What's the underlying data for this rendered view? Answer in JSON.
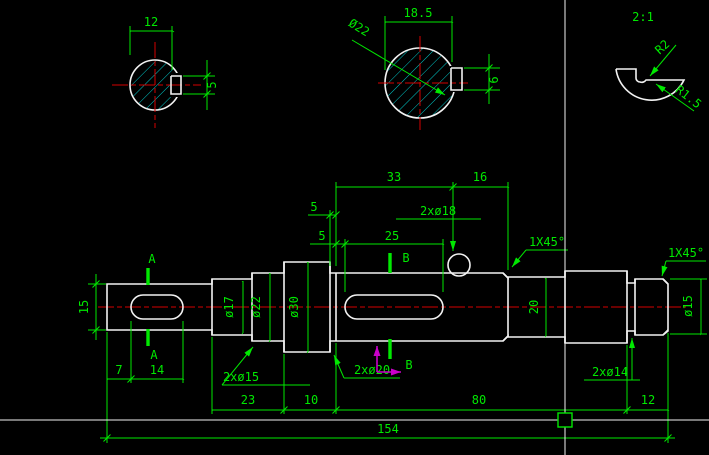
{
  "window": {
    "title": "CAD drawing canvas",
    "background": "#000000"
  },
  "colors": {
    "outline": "#f2f2f2",
    "dimension": "#00e800",
    "centerline": "#d40000",
    "hatch": "#00c8c8",
    "ucs_icon": "#c800c8",
    "crosshair": "#f2f2f2",
    "pickbox": "#00e800"
  },
  "detail_view": {
    "scale_label": "2:1",
    "radius_outer": "R2",
    "radius_inner": "R1.5"
  },
  "section_a_view": {
    "width_dim": "12",
    "keyway_width_dim": "5"
  },
  "section_b_view": {
    "width_dim": "18.5",
    "diameter_label": "Ø22",
    "keyway_width_dim": "6"
  },
  "front_view": {
    "section_letter_a": "A",
    "section_letter_b": "B",
    "dim_15": "15",
    "dim_7": "7",
    "dim_14": "14",
    "groove_2x15": "2xø15",
    "groove_2x20": "2xø20",
    "groove_2x14": "2xø14",
    "holes_2x18": "2xø18",
    "dia_17": "ø17",
    "dia_22": "ø22",
    "dia_30": "ø30",
    "dia_20": "20",
    "dia_15": "ø15",
    "dim_33": "33",
    "dim_16": "16",
    "dim_5_groove": "5",
    "dim_5_key": "5",
    "dim_25": "25",
    "chamfer_left": "1X45°",
    "chamfer_right": "1X45°",
    "dim_23": "23",
    "dim_10": "10",
    "dim_80": "80",
    "dim_12": "12",
    "dim_154": "154"
  }
}
